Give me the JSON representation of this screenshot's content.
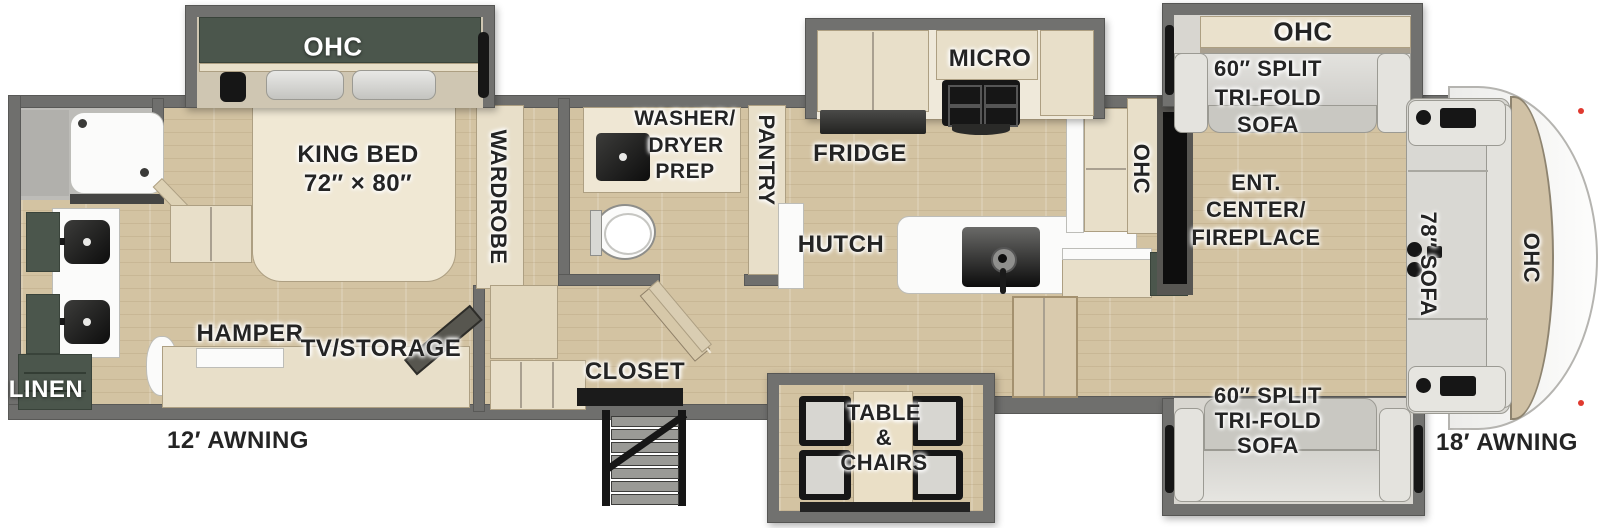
{
  "title": "Fifth wheel RV floorplan",
  "colors": {
    "wall": "#6f6f6d",
    "floor_wood": "#d3c3a2",
    "cabinet_cream": "#e8dfc9",
    "cabinet_dark_green": "#4b564c",
    "sofa_silver": "#d9d8d3",
    "counter_white": "#fbfbfa",
    "fixture_black": "#161616",
    "clearance_light_red": "#e0392f"
  },
  "labels": {
    "bedroom": {
      "ohc": "OHC",
      "bed1": "KING BED",
      "bed2": "72″ × 80″",
      "wardrobe": "WARDROBE",
      "hamper": "HAMPER",
      "tv_storage": "TV/STORAGE"
    },
    "bath_rear": {
      "linen": "LINEN"
    },
    "bath_mid": {
      "washer": [
        "WASHER/",
        "DRYER",
        "PREP"
      ],
      "pantry": "PANTRY"
    },
    "kitchen": {
      "micro": "MICRO",
      "fridge": "FRIDGE",
      "hutch": "HUTCH",
      "ohc": "OHC",
      "closet": "CLOSET"
    },
    "dining": {
      "table": [
        "TABLE",
        "&",
        "CHAIRS"
      ]
    },
    "living": {
      "ent": [
        "ENT.",
        "CENTER/",
        "FIREPLACE"
      ],
      "sofa_top": [
        "60″ SPLIT",
        "TRI-FOLD",
        "SOFA"
      ],
      "sofa_bottom": [
        "60″ SPLIT",
        "TRI-FOLD",
        "SOFA"
      ],
      "front_sofa": "78″ SOFA",
      "ohc_slide": "OHC",
      "ohc_front": "OHC"
    },
    "awning_left": "12′ AWNING",
    "awning_right": "18′ AWNING"
  }
}
